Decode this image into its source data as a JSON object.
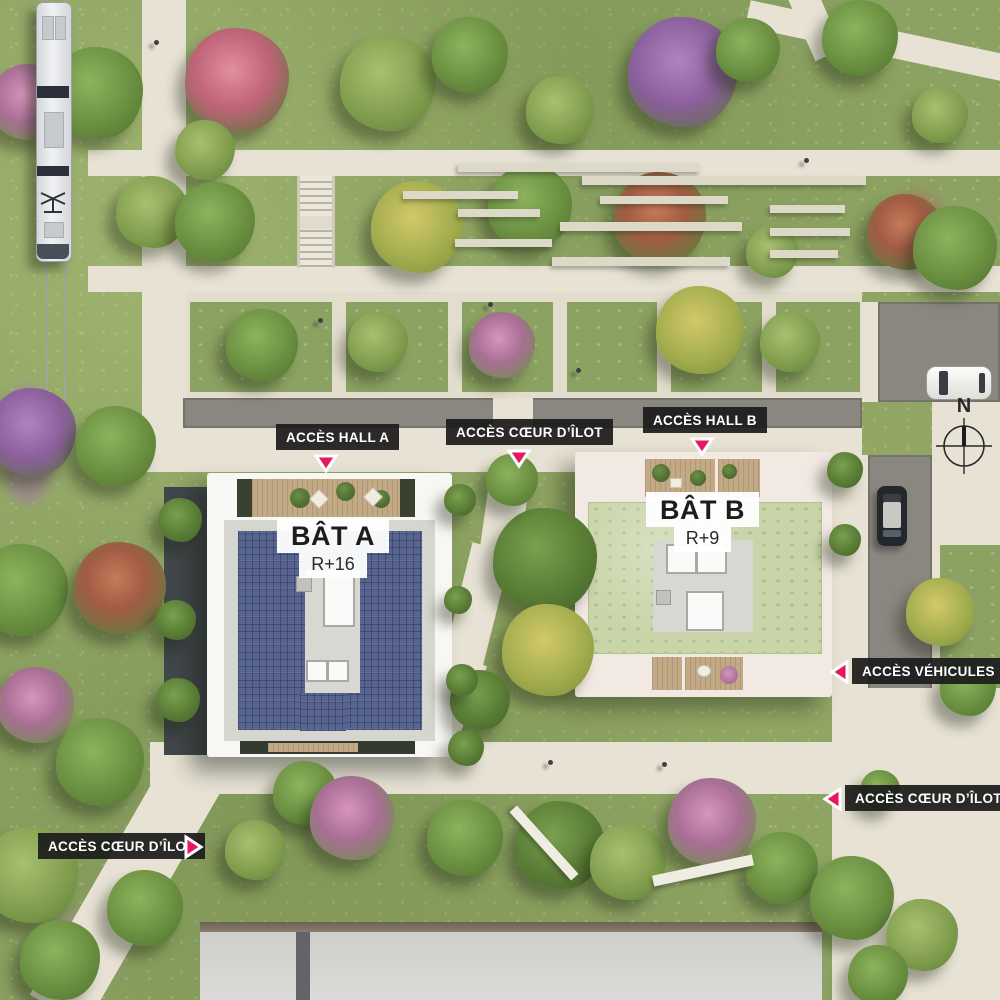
{
  "labels": [
    {
      "id": "acces-hall-a",
      "text": "ACCÈS HALL A",
      "direction": "down"
    },
    {
      "id": "acces-coeur-ilot-top",
      "text": "ACCÈS CŒUR D’ÎLOT",
      "direction": "down"
    },
    {
      "id": "acces-hall-b",
      "text": "ACCÈS HALL B",
      "direction": "down"
    },
    {
      "id": "acces-vehicules",
      "text": "ACCÈS VÉHICULES",
      "direction": "left"
    },
    {
      "id": "acces-coeur-ilot-right",
      "text": "ACCÈS CŒUR D’ÎLOT",
      "direction": "left"
    },
    {
      "id": "acces-coeur-ilot-left",
      "text": "ACCÈS CŒUR D’ÎLOT",
      "direction": "right"
    }
  ],
  "buildings": {
    "a": {
      "name": "BÂT A",
      "floors": "R+16"
    },
    "b": {
      "name": "BÂT B",
      "floors": "R+9"
    }
  },
  "compass": {
    "letter": "N"
  },
  "colors": {
    "accent": "#e6185e",
    "label_background": "#1c1c1c",
    "label_text": "#ffffff",
    "solar_roof": "#57648f",
    "green_roof": "#c9d5a9",
    "building_a_frame": "#f8f7f4",
    "building_b_frame": "#f2e9e2",
    "grass": "#8ca262",
    "path": "#e7e2d4",
    "road": "#8a8680"
  },
  "vegetation": {
    "trees": [
      {
        "x": 97,
        "y": 93,
        "r": 46,
        "v": "g"
      },
      {
        "x": 237,
        "y": 80,
        "r": 52,
        "v": "redpink"
      },
      {
        "x": 28,
        "y": 102,
        "r": 38,
        "v": "pink"
      },
      {
        "x": 205,
        "y": 150,
        "r": 30,
        "v": "g2"
      },
      {
        "x": 152,
        "y": 212,
        "r": 36,
        "v": "g2"
      },
      {
        "x": 215,
        "y": 222,
        "r": 40,
        "v": "g"
      },
      {
        "x": 388,
        "y": 83,
        "r": 48,
        "v": "g2"
      },
      {
        "x": 470,
        "y": 55,
        "r": 38,
        "v": "g"
      },
      {
        "x": 560,
        "y": 110,
        "r": 34,
        "v": "g2"
      },
      {
        "x": 683,
        "y": 72,
        "r": 55,
        "v": "purple"
      },
      {
        "x": 748,
        "y": 50,
        "r": 32,
        "v": "g"
      },
      {
        "x": 860,
        "y": 38,
        "r": 38,
        "v": "g"
      },
      {
        "x": 940,
        "y": 115,
        "r": 28,
        "v": "g2"
      },
      {
        "x": 417,
        "y": 227,
        "r": 46,
        "v": "yellow"
      },
      {
        "x": 530,
        "y": 207,
        "r": 42,
        "v": "g"
      },
      {
        "x": 660,
        "y": 218,
        "r": 46,
        "v": "red"
      },
      {
        "x": 772,
        "y": 252,
        "r": 26,
        "v": "g2"
      },
      {
        "x": 905,
        "y": 232,
        "r": 38,
        "v": "red"
      },
      {
        "x": 955,
        "y": 248,
        "r": 42,
        "v": "g"
      },
      {
        "x": 262,
        "y": 345,
        "r": 36,
        "v": "g"
      },
      {
        "x": 378,
        "y": 342,
        "r": 30,
        "v": "g2"
      },
      {
        "x": 502,
        "y": 345,
        "r": 33,
        "v": "pink"
      },
      {
        "x": 700,
        "y": 330,
        "r": 44,
        "v": "yellow"
      },
      {
        "x": 790,
        "y": 342,
        "r": 30,
        "v": "g2"
      },
      {
        "x": 32,
        "y": 432,
        "r": 44,
        "v": "purple"
      },
      {
        "x": 116,
        "y": 446,
        "r": 40,
        "v": "g"
      },
      {
        "x": 22,
        "y": 590,
        "r": 46,
        "v": "g"
      },
      {
        "x": 120,
        "y": 588,
        "r": 46,
        "v": "red"
      },
      {
        "x": 36,
        "y": 705,
        "r": 38,
        "v": "pink"
      },
      {
        "x": 100,
        "y": 762,
        "r": 44,
        "v": "g"
      },
      {
        "x": 30,
        "y": 875,
        "r": 48,
        "v": "g2"
      },
      {
        "x": 145,
        "y": 908,
        "r": 38,
        "v": "g"
      },
      {
        "x": 60,
        "y": 960,
        "r": 40,
        "v": "g"
      },
      {
        "x": 545,
        "y": 560,
        "r": 52,
        "v": "gd"
      },
      {
        "x": 512,
        "y": 480,
        "r": 26,
        "v": "g"
      },
      {
        "x": 548,
        "y": 650,
        "r": 46,
        "v": "yellow"
      },
      {
        "x": 480,
        "y": 700,
        "r": 30,
        "v": "gd"
      },
      {
        "x": 305,
        "y": 793,
        "r": 32,
        "v": "g"
      },
      {
        "x": 352,
        "y": 818,
        "r": 42,
        "v": "pink"
      },
      {
        "x": 255,
        "y": 850,
        "r": 30,
        "v": "g2"
      },
      {
        "x": 465,
        "y": 838,
        "r": 38,
        "v": "g"
      },
      {
        "x": 560,
        "y": 845,
        "r": 44,
        "v": "gd"
      },
      {
        "x": 628,
        "y": 862,
        "r": 38,
        "v": "g2"
      },
      {
        "x": 712,
        "y": 822,
        "r": 44,
        "v": "pink"
      },
      {
        "x": 782,
        "y": 868,
        "r": 36,
        "v": "g"
      },
      {
        "x": 852,
        "y": 898,
        "r": 42,
        "v": "g"
      },
      {
        "x": 922,
        "y": 935,
        "r": 36,
        "v": "g2"
      },
      {
        "x": 878,
        "y": 975,
        "r": 30,
        "v": "g"
      },
      {
        "x": 940,
        "y": 612,
        "r": 34,
        "v": "yellow"
      },
      {
        "x": 968,
        "y": 688,
        "r": 28,
        "v": "g"
      },
      {
        "x": 880,
        "y": 790,
        "r": 20,
        "v": "g"
      },
      {
        "x": 180,
        "y": 520,
        "r": 22,
        "v": "gd"
      },
      {
        "x": 176,
        "y": 620,
        "r": 20,
        "v": "gd"
      },
      {
        "x": 178,
        "y": 700,
        "r": 22,
        "v": "gd"
      },
      {
        "x": 460,
        "y": 500,
        "r": 16,
        "v": "gd"
      },
      {
        "x": 458,
        "y": 600,
        "r": 14,
        "v": "gd"
      },
      {
        "x": 462,
        "y": 680,
        "r": 16,
        "v": "gd"
      },
      {
        "x": 466,
        "y": 748,
        "r": 18,
        "v": "gd"
      },
      {
        "x": 845,
        "y": 470,
        "r": 18,
        "v": "gd"
      },
      {
        "x": 845,
        "y": 540,
        "r": 16,
        "v": "gd"
      }
    ]
  },
  "street_furniture": {
    "concrete_strips": [
      {
        "x": 458,
        "y": 163,
        "w": 242,
        "h": 9
      },
      {
        "x": 582,
        "y": 176,
        "w": 284,
        "h": 9
      },
      {
        "x": 403,
        "y": 191,
        "w": 115,
        "h": 8
      },
      {
        "x": 600,
        "y": 196,
        "w": 128,
        "h": 8
      },
      {
        "x": 770,
        "y": 205,
        "w": 75,
        "h": 8
      },
      {
        "x": 458,
        "y": 209,
        "w": 82,
        "h": 8
      },
      {
        "x": 560,
        "y": 222,
        "w": 182,
        "h": 9
      },
      {
        "x": 770,
        "y": 228,
        "w": 80,
        "h": 8
      },
      {
        "x": 455,
        "y": 239,
        "w": 97,
        "h": 8
      },
      {
        "x": 552,
        "y": 257,
        "w": 178,
        "h": 9
      },
      {
        "x": 770,
        "y": 250,
        "w": 68,
        "h": 8
      }
    ]
  },
  "people": [
    {
      "x": 154,
      "y": 40
    },
    {
      "x": 318,
      "y": 318
    },
    {
      "x": 488,
      "y": 302
    },
    {
      "x": 576,
      "y": 368
    },
    {
      "x": 548,
      "y": 760
    },
    {
      "x": 662,
      "y": 762
    },
    {
      "x": 804,
      "y": 158
    }
  ]
}
